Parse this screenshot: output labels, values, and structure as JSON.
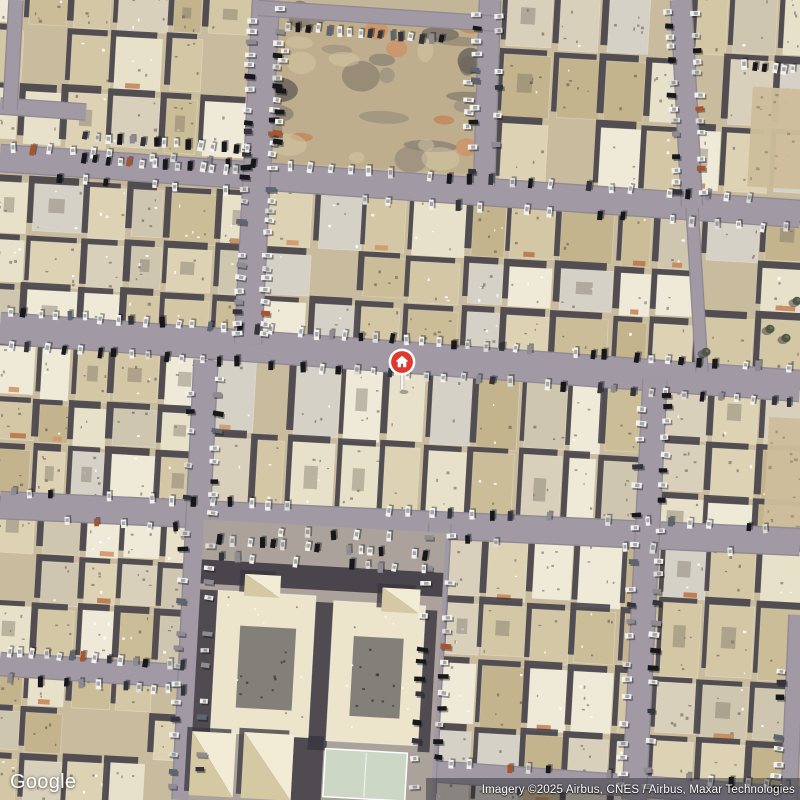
{
  "branding": {
    "logo_text": "Google"
  },
  "attribution": {
    "text": "Imagery ©2025 Airbus, CNES / Airbus, Maxar Technologies"
  },
  "marker": {
    "x": 402,
    "y": 362,
    "color": "#e0382d",
    "ring": "#ffffff",
    "stem": "#f6f3ee",
    "icon": "home"
  },
  "map": {
    "size": 800,
    "seed": 11,
    "rot": 3.2,
    "colors": {
      "ground": "#c3b698",
      "block_ground": "#c9bc9e",
      "street": "#a19aa5",
      "street_edge": "#8f8993",
      "shadow": "#38353e",
      "palette": [
        "#e8e1ca",
        "#ddd3b4",
        "#d3c7a5",
        "#cbbd98",
        "#c4b48e",
        "#efe9d8",
        "#d9d0bc",
        "#cfc6b0",
        "#d6d1c6"
      ],
      "terracotta": [
        "#c78a5f",
        "#d29a6c",
        "#bd7a50"
      ],
      "car_colors": [
        [
          "#f2f1ee",
          42
        ],
        [
          "#dddbd6",
          13
        ],
        [
          "#17171c",
          20
        ],
        [
          "#34343c",
          10
        ],
        [
          "#8e8c92",
          8
        ],
        [
          "#5c6570",
          4
        ],
        [
          "#a8552f",
          3
        ]
      ],
      "dirt": {
        "base": "#bfae8d",
        "rubble": [
          "#8e8578",
          "#7c7468",
          "#6e675e",
          "#99907f"
        ],
        "orange": [
          "#cf8f62",
          "#c28357"
        ],
        "light": "#d5c7a6"
      },
      "school": {
        "ground": "#aba39b",
        "cream": "#ece4cb",
        "pyr_light": "#f2ecd6",
        "pyr_dark": "#d5c9a4",
        "court": "#83807a",
        "green": "#ccd8c5"
      },
      "sand": "#cdbd9b",
      "tree": "#4c5542"
    },
    "streets": [
      [
        0,
        328,
        800,
        386,
        30
      ],
      [
        0,
        158,
        800,
        214,
        26
      ],
      [
        0,
        505,
        800,
        542,
        26
      ],
      [
        0,
        664,
        192,
        677,
        22
      ],
      [
        415,
        770,
        800,
        798,
        20
      ],
      [
        0,
        106,
        86,
        112,
        15
      ],
      [
        16,
        0,
        10,
        110,
        13
      ],
      [
        266,
        0,
        248,
        344,
        26
      ],
      [
        490,
        0,
        484,
        186,
        20
      ],
      [
        681,
        0,
        692,
        206,
        20
      ],
      [
        692,
        208,
        702,
        372,
        11
      ],
      [
        206,
        360,
        184,
        800,
        23
      ],
      [
        655,
        380,
        634,
        800,
        23
      ],
      [
        440,
        524,
        424,
        800,
        21
      ],
      [
        797,
        615,
        789,
        800,
        15
      ],
      [
        258,
        8,
        500,
        24,
        14
      ]
    ],
    "blocks": [
      {
        "x": -12,
        "y": -10,
        "w": 268,
        "h": 162,
        "cols": 6,
        "rows": 3
      },
      {
        "x": 500,
        "y": -8,
        "w": 190,
        "h": 200,
        "cols": 4,
        "rows": 3
      },
      {
        "x": 690,
        "y": -10,
        "w": 122,
        "h": 205,
        "cols": 3,
        "rows": 3
      },
      {
        "x": -12,
        "y": 186,
        "w": 272,
        "h": 162,
        "cols": 6,
        "rows": 3
      },
      {
        "x": 258,
        "y": 196,
        "w": 442,
        "h": 166,
        "cols": 9,
        "rows": 3,
        "accent": 0.3
      },
      {
        "x": 700,
        "y": 210,
        "w": 112,
        "h": 172,
        "cols": 2,
        "rows": 3
      },
      {
        "x": -12,
        "y": 348,
        "w": 217,
        "h": 160,
        "cols": 5,
        "rows": 3
      },
      {
        "x": 205,
        "y": 365,
        "w": 445,
        "h": 165,
        "cols": 10,
        "rows": 2
      },
      {
        "x": 650,
        "y": 382,
        "w": 162,
        "h": 166,
        "cols": 3,
        "rows": 3
      },
      {
        "x": -12,
        "y": 505,
        "w": 210,
        "h": 163,
        "cols": 5,
        "rows": 3
      },
      {
        "x": -12,
        "y": 668,
        "w": 207,
        "h": 144,
        "cols": 5,
        "rows": 3
      },
      {
        "x": 440,
        "y": 535,
        "w": 215,
        "h": 275,
        "cols": 5,
        "rows": 4
      },
      {
        "x": 655,
        "y": 545,
        "w": 157,
        "h": 265,
        "cols": 3,
        "rows": 4
      }
    ],
    "dirt_lot": {
      "x": 268,
      "y": 10,
      "w": 214,
      "h": 158
    },
    "sand_patches": [
      {
        "x": 750,
        "y": 88,
        "w": 54,
        "h": 100
      },
      {
        "x": 766,
        "y": 418,
        "w": 38,
        "h": 112
      }
    ],
    "school": {
      "site": [
        196,
        526,
        242,
        284
      ],
      "top_shadow": [
        196,
        566,
        242,
        24
      ],
      "wings": [
        {
          "b": [
            214,
            596,
            98,
            142
          ],
          "c": [
            238,
            630,
            56,
            82
          ]
        },
        {
          "b": [
            330,
            600,
            92,
            140
          ],
          "c": [
            352,
            634,
            50,
            80
          ]
        }
      ],
      "shadows": [
        [
          196,
          596,
          18,
          152
        ],
        [
          312,
          602,
          19,
          148
        ],
        [
          422,
          604,
          12,
          142
        ],
        [
          298,
          736,
          30,
          70
        ],
        [
          214,
          738,
          10,
          60
        ]
      ],
      "pyramids": [
        [
          240,
          578,
          36,
          22
        ],
        [
          378,
          584,
          38,
          24
        ],
        [
          196,
          738,
          44,
          64
        ],
        [
          248,
          736,
          50,
          66
        ]
      ],
      "court": [
        330,
        748,
        82,
        48
      ]
    },
    "trees": [
      [
        770,
        329
      ],
      [
        786,
        338
      ],
      [
        797,
        301
      ],
      [
        706,
        352
      ]
    ],
    "car_strips": [
      {
        "l": [
          2,
          311,
          798,
          369
        ],
        "n": 52
      },
      {
        "l": [
          2,
          345,
          798,
          403
        ],
        "n": 46
      },
      {
        "l": [
          253,
          4,
          237,
          340
        ],
        "n": 30
      },
      {
        "l": [
          281,
          4,
          263,
          340
        ],
        "n": 30
      },
      {
        "l": [
          2,
          147,
          798,
          201
        ],
        "n": 40,
        "s": 0.2
      },
      {
        "l": [
          2,
          175,
          798,
          229
        ],
        "n": 34,
        "s": 0.35
      },
      {
        "l": [
          282,
          26,
          448,
          40
        ],
        "n": 16
      },
      {
        "l": [
          285,
          45,
          277,
          148
        ],
        "n": 10
      },
      {
        "l": [
          470,
          60,
          466,
          150
        ],
        "n": 6,
        "s": 0.4
      },
      {
        "l": [
          80,
          136,
          252,
          150
        ],
        "n": 15
      },
      {
        "l": [
          78,
          158,
          254,
          172
        ],
        "n": 15,
        "s": 0.2
      },
      {
        "l": [
          477,
          8,
          472,
          180
        ],
        "n": 13,
        "s": 0.3
      },
      {
        "l": [
          500,
          8,
          496,
          180
        ],
        "n": 12,
        "s": 0.4
      },
      {
        "l": [
          668,
          6,
          678,
          200
        ],
        "n": 16
      },
      {
        "l": [
          694,
          6,
          704,
          200
        ],
        "n": 16
      },
      {
        "l": [
          700,
          62,
          798,
          70
        ],
        "n": 10,
        "s": 0.3
      },
      {
        "l": [
          2,
          492,
          798,
          529
        ],
        "n": 40,
        "s": 0.25
      },
      {
        "l": [
          2,
          519,
          798,
          556
        ],
        "n": 30,
        "s": 0.4
      },
      {
        "l": [
          192,
          370,
          172,
          795
        ],
        "n": 25,
        "s": 0.35
      },
      {
        "l": [
          219,
          370,
          199,
          795
        ],
        "n": 25,
        "s": 0.3
      },
      {
        "l": [
          642,
          385,
          621,
          795
        ],
        "n": 27,
        "s": 0.3
      },
      {
        "l": [
          668,
          385,
          647,
          795
        ],
        "n": 27,
        "s": 0.3
      },
      {
        "l": [
          429,
          530,
          413,
          795
        ],
        "n": 17,
        "s": 0.4
      },
      {
        "l": [
          452,
          530,
          436,
          795
        ],
        "n": 17,
        "s": 0.35
      },
      {
        "l": [
          2,
          652,
          190,
          665
        ],
        "n": 15
      },
      {
        "l": [
          2,
          678,
          190,
          691
        ],
        "n": 13,
        "s": 0.3
      },
      {
        "l": [
          214,
          540,
          430,
          556
        ],
        "n": 20,
        "s": 0.25
      },
      {
        "l": [
          216,
          556,
          430,
          570
        ],
        "n": 15,
        "s": 0.45
      },
      {
        "l": [
          784,
          625,
          776,
          795
        ],
        "n": 13,
        "s": 0.3
      },
      {
        "l": [
          420,
          762,
          798,
          786
        ],
        "n": 19,
        "s": 0.35
      }
    ]
  }
}
